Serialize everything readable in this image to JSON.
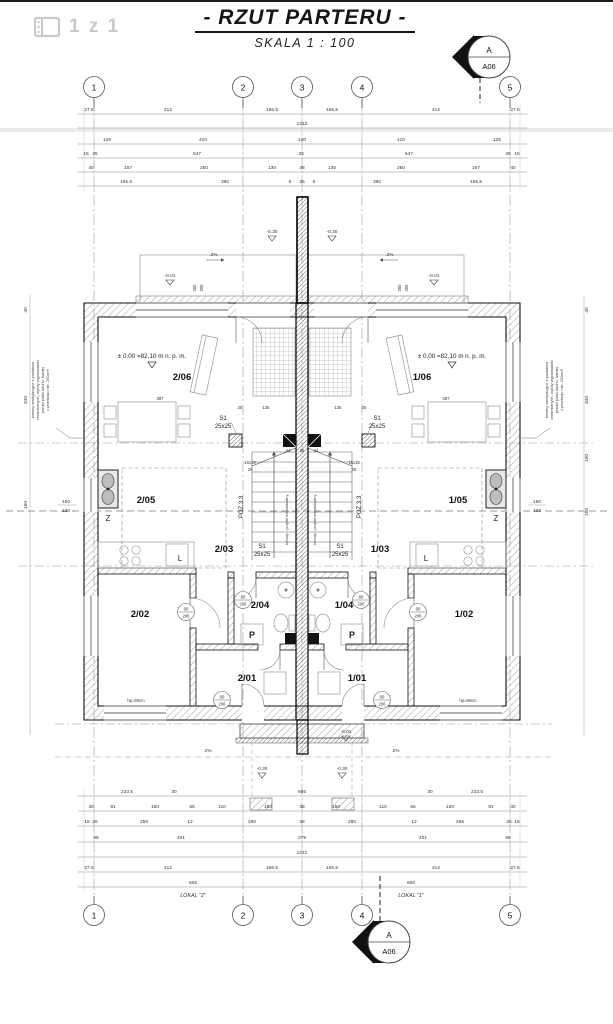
{
  "viewer": {
    "pages": "1 z 1"
  },
  "title_block": {
    "title": "- RZUT PARTERU -",
    "scale": "SKALA 1 : 100"
  },
  "marker": {
    "letter": "A",
    "sheet": "A06"
  },
  "grid": {
    "bubbles": [
      "1",
      "2",
      "3",
      "4",
      "5"
    ]
  },
  "dims": {
    "top": {
      "r1": [
        "27.5",
        "412",
        "166.5",
        "166.5",
        "412",
        "27.5"
      ],
      "r2": [
        "1212"
      ],
      "r3": [
        "126",
        "410",
        "140",
        "410",
        "126"
      ],
      "r4": [
        "15",
        "25",
        "547",
        "33",
        "547",
        "25",
        "15"
      ],
      "r5": [
        "40",
        "167",
        "250",
        "130",
        "38",
        "130",
        "250",
        "167",
        "40"
      ],
      "r6": [
        "155.5",
        "390",
        "5",
        "25",
        "5",
        "390",
        "155.5"
      ]
    },
    "bottom": {
      "r1": [
        "233.5",
        "30",
        "666",
        "30",
        "233.5"
      ],
      "r2": [
        "40",
        "81",
        "150",
        "56",
        "110",
        "150",
        "38",
        "150",
        "110",
        "56",
        "150",
        "81",
        "40"
      ],
      "r3": [
        "15",
        "25",
        "255",
        "12",
        "280",
        "38",
        "280",
        "12",
        "255",
        "25",
        "15"
      ],
      "r4": [
        "68",
        "401",
        "279",
        "401",
        "68"
      ],
      "r5": [
        "1212"
      ],
      "r6": [
        "27.5",
        "412",
        "166.5",
        "166.5",
        "412",
        "27.5"
      ],
      "r7": [
        "606",
        "606"
      ],
      "lokal": [
        "LOKAL \"2\"",
        "LOKAL \"1\""
      ]
    },
    "left_margin": [
      "40",
      "340",
      "150"
    ],
    "right_margin": [
      "40",
      "340",
      "100",
      "150"
    ],
    "window_mark": [
      "150",
      "120"
    ],
    "stair_top": [
      "25",
      "135",
      "135",
      "25"
    ],
    "table": [
      "387",
      "387"
    ],
    "party": [
      "44",
      "25",
      "44"
    ],
    "terrace": [
      "350",
      "305",
      "350",
      "305"
    ]
  },
  "rooms": {
    "l_living": "2/06",
    "l_kitchen": "2/05",
    "l_hall": "2/03",
    "l_bedroom": "2/02",
    "l_bath": "2/04",
    "l_entry": "2/01",
    "r_living": "1/06",
    "r_kitchen": "1/05",
    "r_hall": "1/03",
    "r_bedroom": "1/02",
    "r_bath": "1/04",
    "r_entry": "1/01"
  },
  "levels": {
    "zero": "± 0.00 =82,10 m n. p. m.",
    "m030": "-0.30",
    "m001": "-0.01",
    "slope": "2%"
  },
  "ann": {
    "s1": "S1",
    "s1s": "25x25",
    "poz": "POZ.3.3",
    "run": "16x18",
    "tread": "25",
    "stairs": "schody - projekt indywidualny",
    "hp": "hp=90cm",
    "fridge": "L",
    "washer": "P",
    "sink": "Z",
    "dw90": "90",
    "dw80": "80",
    "dh": "206"
  },
  "note": {
    "l1": "kominy wentylacyjne z pustaków",
    "l2": "ceramicznych, wyloty wyprowadzić",
    "l3": "ponad połać dachu, kanały",
    "l4": "o przekroju min. 200cm²"
  }
}
